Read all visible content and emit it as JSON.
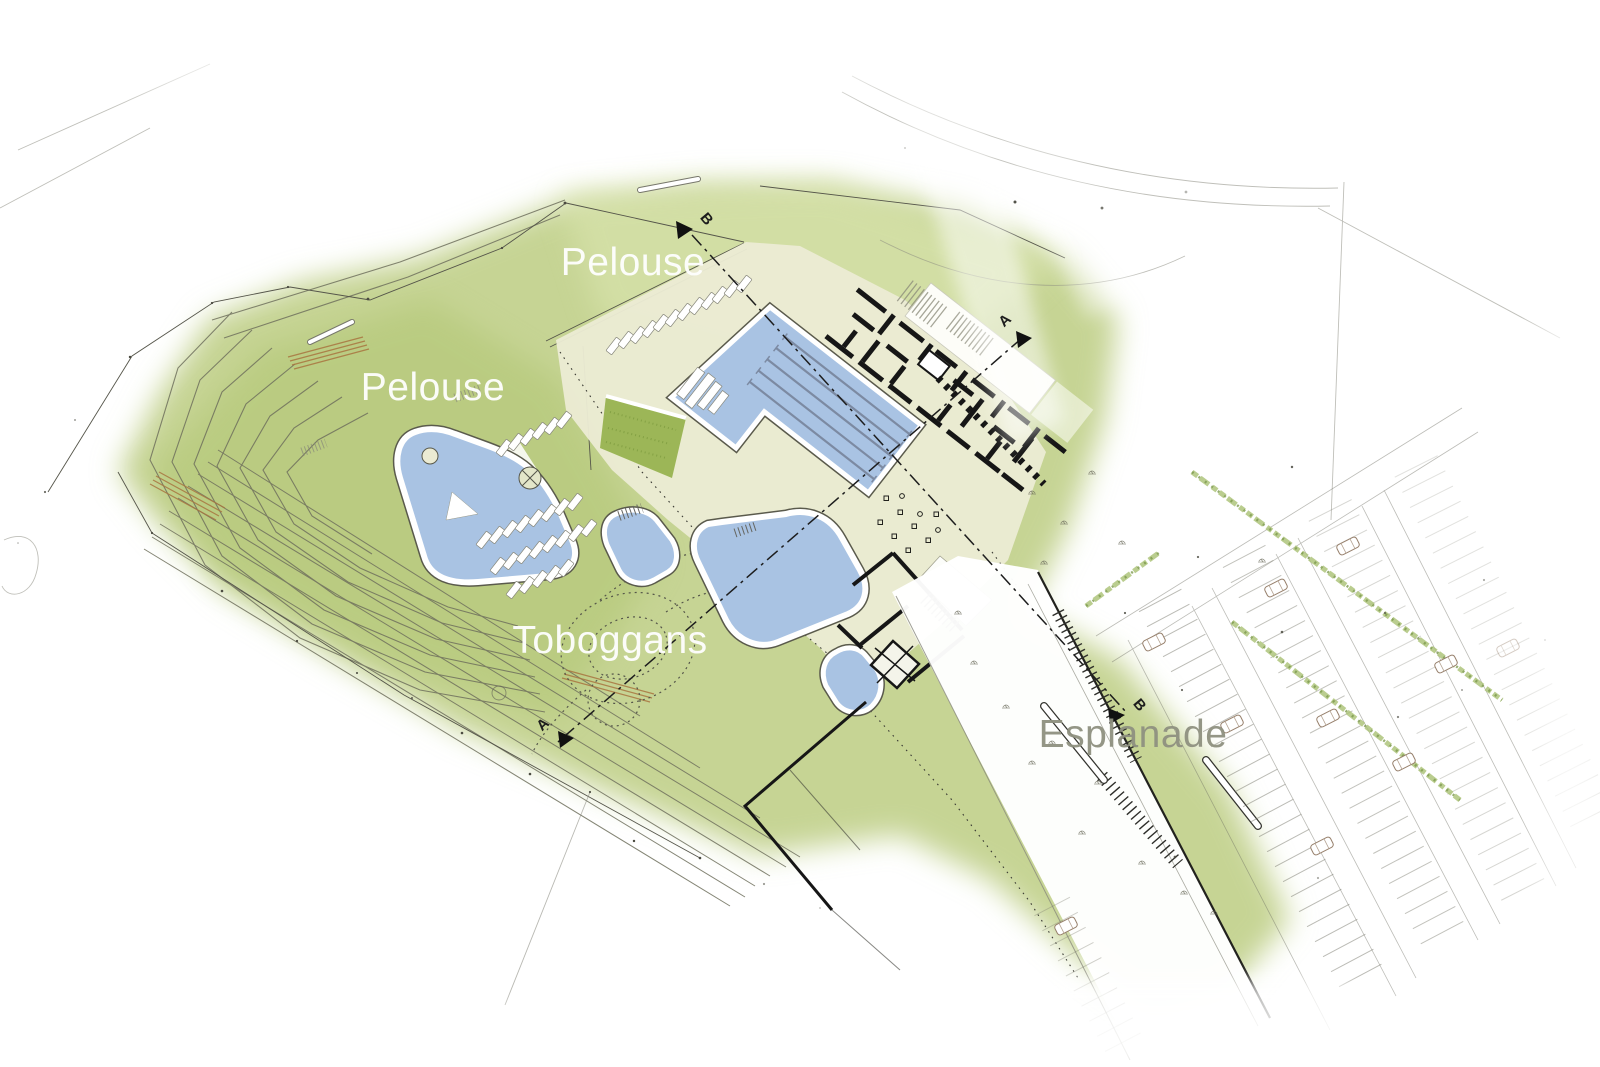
{
  "plan": {
    "labels": {
      "pelouse_top": "Pelouse",
      "pelouse_left": "Pelouse",
      "toboggans": "Toboggans",
      "esplanade": "Esplanade"
    },
    "sections": {
      "a": "A",
      "b": "B"
    },
    "colors": {
      "lawn": "#c6d494",
      "lawn_shade": "#afc470",
      "lawn_light": "#dde7b2",
      "deck": "#ebebd3",
      "water": "#a9c3e3",
      "water_edge": "#5a5a4c",
      "lane": "#7c8aa2",
      "building": "#161616",
      "planted": "#9cb657",
      "tree": "#4b4b41",
      "contour": "#6f705d",
      "wood": "#a8743f",
      "hedge": "#a9c173",
      "section_line": "#1d1d1d",
      "label_white": "#ffffff",
      "label_grey": "#8f9180"
    }
  }
}
